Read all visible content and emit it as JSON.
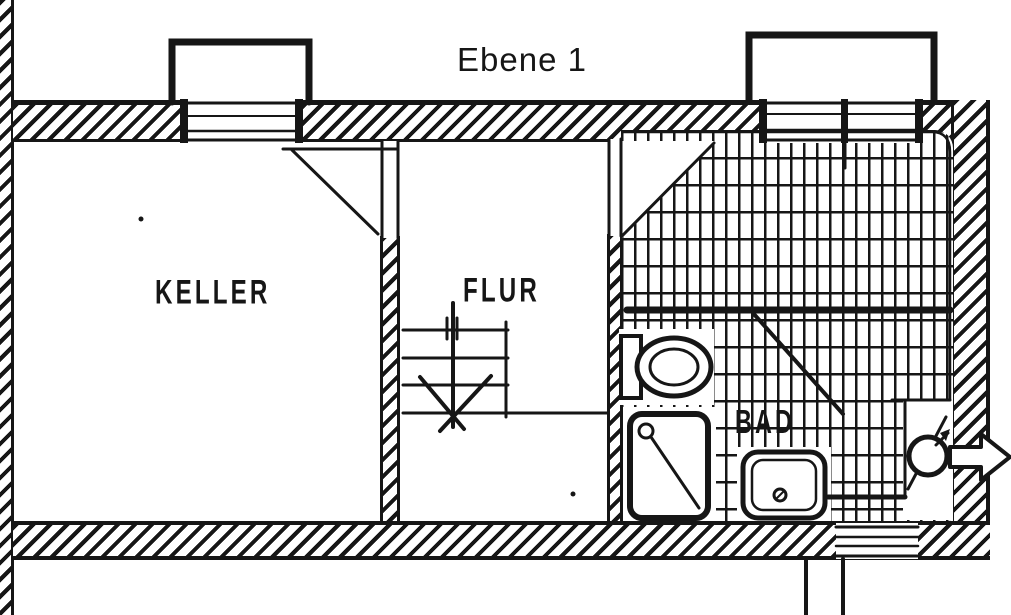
{
  "title": "Ebene 1",
  "rooms": {
    "keller": {
      "label": "KELLER"
    },
    "flur": {
      "label": "FLUR"
    },
    "bad": {
      "label": "BAD"
    }
  },
  "symbols": {
    "toilet": "toilet-plan-symbol",
    "shower": "shower-tray-symbol",
    "washbasin": "washbasin-symbol",
    "water_heater": "water-heater-circle-symbol",
    "stairs": "stairs-up-symbol",
    "exit_arrow": "exit-direction-arrow",
    "window": "basement-window-symbol",
    "door": "door-swing-symbol"
  },
  "colors": {
    "ink": "#161616",
    "paper": "#ffffff"
  }
}
